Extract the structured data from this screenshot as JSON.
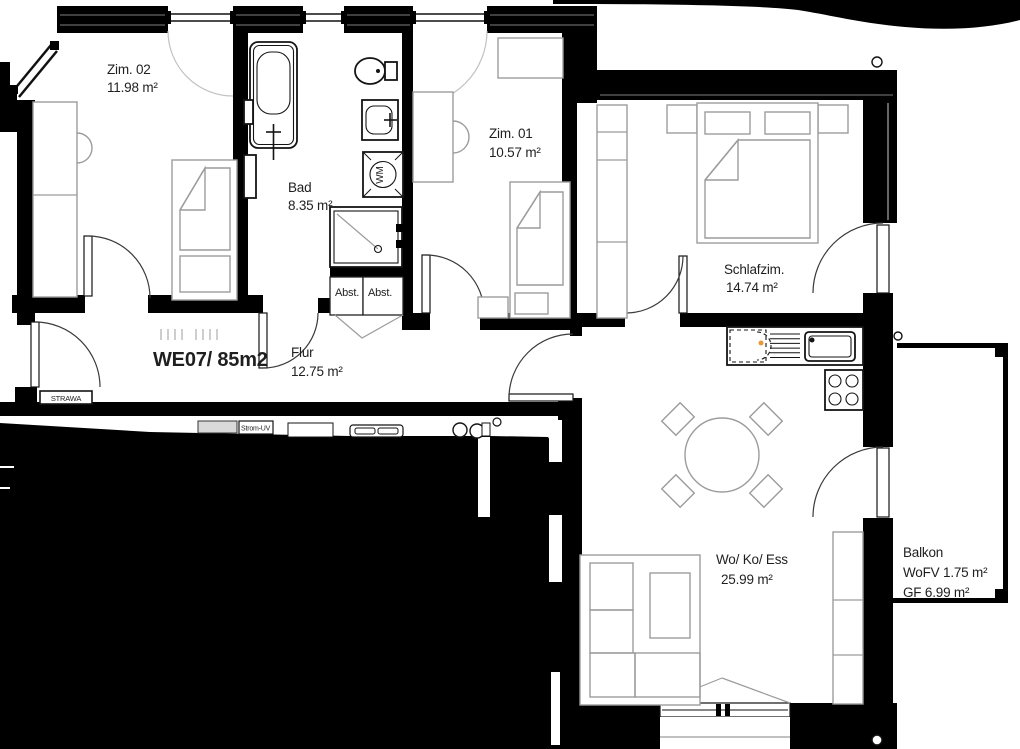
{
  "plan": {
    "title": "Wohnungsgrundriss WE07",
    "unit_label": "WE07/ 85m2",
    "unit_label_color": "#ec1c24",
    "rooms": [
      {
        "id": "zim02",
        "name": "Zim. 02",
        "area": "11.98 m²"
      },
      {
        "id": "bad",
        "name": "Bad",
        "area": "8.35 m²"
      },
      {
        "id": "zim01",
        "name": "Zim. 01",
        "area": "10.57 m²"
      },
      {
        "id": "schlafzim",
        "name": "Schlafzim.",
        "area": "14.74 m²"
      },
      {
        "id": "flur",
        "name": "Flur",
        "area": "12.75 m²"
      },
      {
        "id": "wokoess",
        "name": "Wo/ Ko/ Ess",
        "area": "25.99 m²"
      }
    ],
    "balcony": {
      "name": "Balkon",
      "wofv": "WoFV 1.75 m²",
      "gf": "GF 6.99 m²"
    },
    "storage": {
      "abst1": "Abst.",
      "abst2": "Abst."
    },
    "equipment": {
      "strawa": "STRAWA",
      "strom_uv": "Strom-UV",
      "wm": "WM"
    },
    "colors": {
      "wall": "#000000",
      "furniture": "#9c9c9c",
      "fixture": "#141414"
    }
  }
}
